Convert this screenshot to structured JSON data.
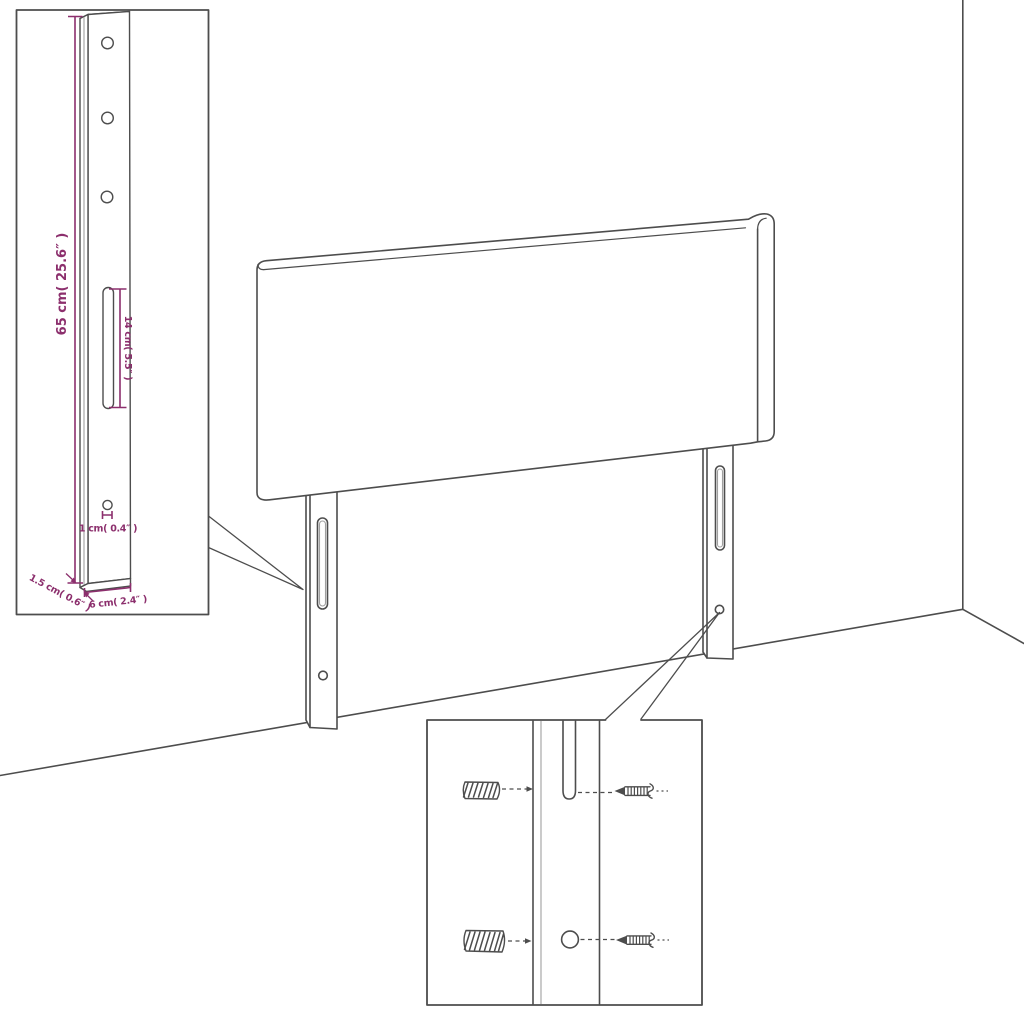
{
  "colors": {
    "line": "#4d4d4d",
    "line_light": "#a0a0a0",
    "dimension": "#8c2f6d",
    "background": "#ffffff"
  },
  "labels": {
    "leg_height": "65 cm( 25.6″ )",
    "slot_length": "14 cm( 5.5″ )",
    "hole_diameter": "1 cm( 0.4″ )",
    "leg_thickness": "1.5 cm( 0.6″ )",
    "leg_width": "6 cm( 2.4″ )"
  }
}
